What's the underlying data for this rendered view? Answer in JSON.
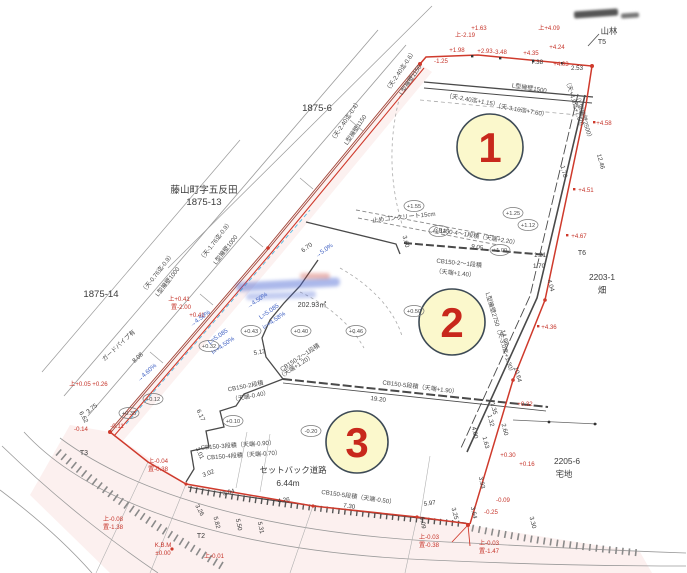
{
  "document": "宅地分譲区画図",
  "lots": [
    "1",
    "2",
    "3"
  ],
  "area": "202.93㎡",
  "parcels": {
    "p_top": "1875-6",
    "p_name": "藤山町字五反田",
    "p_name2": "1875-13",
    "p_left": "1875-14",
    "p_forest": "山林",
    "p_right": "2203-1",
    "p_right_t": "畑",
    "p_br": "2205-6",
    "p_br_t": "宅地"
  },
  "road": {
    "setback1": "セットバック道路",
    "setback2": "6.44m",
    "guard": "ガードパイプ有"
  },
  "points": {
    "t2": "T2",
    "t3": "T3",
    "t5": "T5",
    "t6": "T6"
  },
  "benchmark": [
    "K.B.M",
    "±0.00"
  ],
  "walls": [
    "L型擁壁1500",
    "（天-2.40迄+1.15）",
    "（天-3.10迄+7.60）",
    "（天-2.40迄-0.6）",
    "L型擁壁1150",
    "（天-2.40迄-0.4）",
    "L型擁壁1150",
    "（天-1.76迄-0.9）",
    "L型擁壁1000",
    "（天-0.76迄-0.9）",
    "L型擁壁1000",
    "止めコンクリート15cm",
    "CB150-4～1段積（天端+2.20）",
    "CB150-2～1段積",
    "（天端+1.40）",
    "CB150-5段積（天端+1.90）",
    "CB150-2段積",
    "（天端-0.40）",
    "CB150-3段積（天端-0.90）",
    "CB150-4段積（天端-0.70）",
    "CB150-5段積（天端-0.50）",
    "（天+4.0迄+7.60）",
    "（L型擁壁2500）",
    "L型擁壁2750（天-3.0迄+1.30）",
    "CB150-2～1段積",
    "（天端+1.20）"
  ],
  "dims": [
    "7.38",
    "2.53",
    "12.46",
    "9.05",
    "3.60",
    "6.70",
    "1.21",
    "1.70",
    "4.04",
    "14.68",
    "10.64",
    "19.20",
    "5.13",
    "6.17",
    "3.01",
    "3.02",
    "3.04",
    "4.26",
    "7.30",
    "3.26",
    "5.82",
    "5.50",
    "5.31",
    "6.09",
    "3.25",
    "3.30",
    "5.97",
    "1.35",
    "1.32",
    "2.60",
    "1.63",
    "4.00",
    "3.93",
    "3.64",
    "8.08",
    "6.62",
    "3.75",
    "1.78"
  ],
  "elev": [
    "+1.63",
    "上-2.19",
    "+1.98",
    "+2.93",
    "-3.48",
    "+4.35",
    "+4.24",
    "+4.03",
    "上+4.09",
    "-1.25",
    "+4.58",
    "+4.51",
    "+4.67",
    "+4.36",
    "+0.32",
    "+0.30",
    "+0.16",
    "-0.09",
    "-0.25",
    "上-0.03",
    "置-0.38",
    "上-0.03",
    "置-1.47",
    "上-0.04",
    "置-0.38",
    "上+0.05",
    "+0.26",
    "-0.14",
    "-0.11",
    "上+0.41",
    "置-2.00",
    "+0.41",
    "上-0.01",
    "上-0.08",
    "置-1.38"
  ],
  "circled": [
    "+1.55",
    "+1.14",
    "+1.25",
    "+1.12",
    "+1.00",
    "+0.50",
    "+0.46",
    "+0.40",
    "+0.43",
    "+0.32",
    "+0.12",
    "+0.35",
    "+0.10",
    "-0.20"
  ],
  "slopes": [
    "→4.60%",
    "→4.50%",
    "→4.50%",
    "L=5.085",
    "i=+4.58%",
    "L=5.085",
    "i=+4.50%",
    "→5.0%"
  ]
}
